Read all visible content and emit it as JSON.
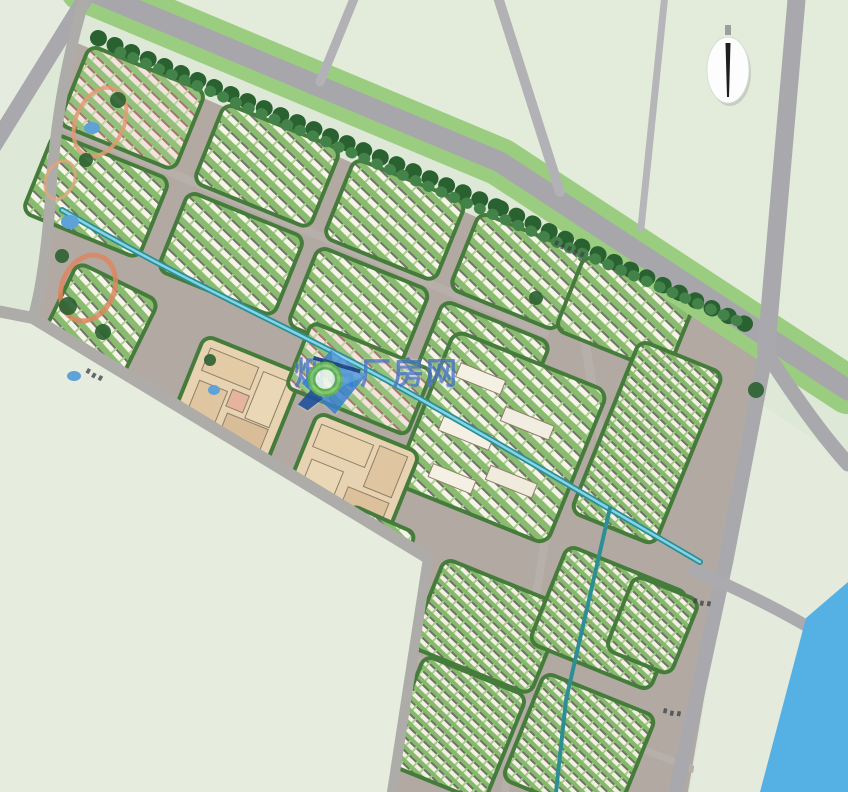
{
  "watermark": {
    "text": "烟台厂房网",
    "logo_name": "magnifier-diamond-logo",
    "color": "#2058c6"
  },
  "palette": {
    "background": "#dee8d7",
    "field_sw": "#e7edde",
    "field_ne": "#e3ecda",
    "field_tl": "#e5ecdf",
    "field_e": "#e4ebdc",
    "estate_street": "#b2aaa2",
    "road_major": "#a7a7ab",
    "road_minor": "#b2b1b5",
    "verge_green": "#9bcd80",
    "tree_dark": "#2a6130",
    "tree_light": "#43834a",
    "canal": "#2d8f94",
    "canal_highlight": "#84d4ea",
    "river": "#55b1e4",
    "campus_beige": "#e7d3b2",
    "block_edge_green": "#467c3b"
  },
  "map": {
    "estate_base": "75,42 770,345 750,400 728,558 688,792 392,792 428,556 33,318 48,205 58,86",
    "streets": [
      {
        "name": "street-upper-mid",
        "d": "M 58,124 L 545,333",
        "w": 8,
        "c": "#b7b0aa"
      },
      {
        "name": "street-vertical-east",
        "d": "M 560,192 L 612,505",
        "w": 9,
        "c": "#b7b0aa"
      },
      {
        "name": "street-canal-corridor",
        "d": "M 62,210 C 220,300 380,380 700,562",
        "w": 13,
        "c": "#b2aaa2"
      },
      {
        "name": "street-tail-mid",
        "d": "M 545,540 L 505,792",
        "w": 8,
        "c": "#b7b0aa"
      },
      {
        "name": "street-tail-cross",
        "d": "M 408,655 L 695,770",
        "w": 7,
        "c": "#b7b0aa"
      }
    ],
    "blocks": [
      {
        "name": "block-row-a1",
        "x": 90,
        "y": 45,
        "rot": 22,
        "w": 125,
        "h": 85,
        "rx": 10,
        "fill": "rowsPink"
      },
      {
        "name": "block-row-a2",
        "x": 225,
        "y": 103,
        "rot": 22,
        "w": 125,
        "h": 85,
        "rx": 10,
        "fill": "rows"
      },
      {
        "name": "block-row-a3",
        "x": 355,
        "y": 158,
        "rot": 22,
        "w": 120,
        "h": 85,
        "rx": 10,
        "fill": "rows"
      },
      {
        "name": "block-row-a4",
        "x": 480,
        "y": 212,
        "rot": 22,
        "w": 115,
        "h": 82,
        "rx": 10,
        "fill": "rows"
      },
      {
        "name": "block-row-b1",
        "x": 54,
        "y": 133,
        "rot": 22,
        "w": 125,
        "h": 85,
        "rx": 10,
        "fill": "rows"
      },
      {
        "name": "block-row-b2",
        "x": 189,
        "y": 191,
        "rot": 22,
        "w": 125,
        "h": 85,
        "rx": 10,
        "fill": "rows"
      },
      {
        "name": "block-row-b3",
        "x": 319,
        "y": 246,
        "rot": 22,
        "w": 120,
        "h": 85,
        "rx": 10,
        "fill": "rows"
      },
      {
        "name": "block-row-b4",
        "x": 444,
        "y": 300,
        "rot": 22,
        "w": 115,
        "h": 80,
        "rx": 10,
        "fill": "rows"
      },
      {
        "name": "block-upper-right",
        "x": 585,
        "y": 255,
        "rot": 22,
        "w": 120,
        "h": 80,
        "rx": 10,
        "fill": "rows"
      },
      {
        "name": "block-mid-large",
        "x": 455,
        "y": 330,
        "rot": 22,
        "w": 165,
        "h": 165,
        "rx": 12,
        "fill": "rows",
        "inner": [
          {
            "x": 18,
            "y": 28,
            "w": 48,
            "h": 15,
            "f": "#f4f1e4"
          },
          {
            "x": 76,
            "y": 52,
            "w": 52,
            "h": 15,
            "f": "#f1ede0"
          },
          {
            "x": 22,
            "y": 84,
            "w": 54,
            "h": 15,
            "f": "#f4f1e4"
          },
          {
            "x": 84,
            "y": 112,
            "w": 50,
            "h": 15,
            "f": "#efebdd"
          },
          {
            "x": 30,
            "y": 132,
            "w": 46,
            "h": 14,
            "f": "#f4f1e4"
          }
        ]
      },
      {
        "name": "block-mid-east",
        "x": 640,
        "y": 340,
        "rot": 22,
        "w": 90,
        "h": 185,
        "rx": 10,
        "fill": "rowsDense"
      },
      {
        "name": "block-lower-west",
        "x": 78,
        "y": 262,
        "rot": 26,
        "w": 90,
        "h": 120,
        "rx": 10,
        "fill": "rows"
      },
      {
        "name": "block-campus-west",
        "x": 205,
        "y": 335,
        "rot": 22,
        "w": 105,
        "h": 100,
        "rx": 10,
        "fill": "campus",
        "inner": [
          {
            "x": 10,
            "y": 10,
            "w": 52,
            "h": 24,
            "f": "#e3cba6"
          },
          {
            "x": 68,
            "y": 12,
            "w": 26,
            "h": 50,
            "f": "#ead7b6"
          },
          {
            "x": 12,
            "y": 44,
            "w": 30,
            "h": 38,
            "f": "#e0c6a0"
          },
          {
            "x": 50,
            "y": 64,
            "w": 44,
            "h": 26,
            "f": "#d8bd98"
          },
          {
            "x": 46,
            "y": 40,
            "w": 18,
            "h": 18,
            "f": "#e6b49e"
          }
        ]
      },
      {
        "name": "block-campus-east",
        "x": 318,
        "y": 412,
        "rot": 22,
        "w": 110,
        "h": 95,
        "rx": 10,
        "fill": "campus",
        "inner": [
          {
            "x": 8,
            "y": 10,
            "w": 56,
            "h": 24,
            "f": "#e8d2ae"
          },
          {
            "x": 70,
            "y": 8,
            "w": 30,
            "h": 44,
            "f": "#e0c6a0"
          },
          {
            "x": 12,
            "y": 46,
            "w": 34,
            "h": 36,
            "f": "#ead7b6"
          },
          {
            "x": 56,
            "y": 58,
            "w": 44,
            "h": 26,
            "f": "#dcc19c"
          }
        ]
      },
      {
        "name": "block-watermark-rows",
        "x": 312,
        "y": 322,
        "rot": 22,
        "w": 130,
        "h": 70,
        "rx": 8,
        "fill": "rowsPink"
      },
      {
        "name": "block-gap-south",
        "x": 352,
        "y": 505,
        "rot": 24,
        "w": 70,
        "h": 40,
        "rx": 8,
        "fill": "rows"
      },
      {
        "name": "block-tail-1",
        "x": 445,
        "y": 558,
        "rot": 22,
        "w": 130,
        "h": 95,
        "rx": 10,
        "fill": "rowsDense"
      },
      {
        "name": "block-tail-2",
        "x": 568,
        "y": 545,
        "rot": 22,
        "w": 130,
        "h": 105,
        "rx": 10,
        "fill": "rowsDense"
      },
      {
        "name": "block-tail-3",
        "x": 425,
        "y": 655,
        "rot": 22,
        "w": 110,
        "h": 115,
        "rx": 10,
        "fill": "rowsDense"
      },
      {
        "name": "block-tail-4",
        "x": 545,
        "y": 672,
        "rot": 22,
        "w": 120,
        "h": 115,
        "rx": 10,
        "fill": "rowsDense"
      },
      {
        "name": "block-tail-se",
        "x": 635,
        "y": 575,
        "rot": 22,
        "w": 70,
        "h": 80,
        "rx": 10,
        "fill": "rowsDense"
      }
    ],
    "canal": {
      "name": "canal",
      "d": "M 62,210 C 200,290 300,332 390,382 S 560,480 700,562"
    },
    "canal_branch": {
      "name": "canal-branch",
      "d": "M 610,508 L 566,700 L 556,792"
    },
    "fields": [
      {
        "name": "field-southwest",
        "pts": "0,312 30,316 425,556 390,792 0,792",
        "c": "#e7edde"
      },
      {
        "name": "field-northeast",
        "pts": "86,-12 500,160 848,388 848,-12",
        "c": "#e3ecda"
      },
      {
        "name": "field-topleft",
        "pts": "-5,-5 88,-5 -5,152",
        "c": "#e5ecdf"
      },
      {
        "name": "field-east",
        "pts": "752,398 728,560 690,792 775,792 848,658 848,462",
        "c": "#e4ebdc"
      }
    ],
    "roads": [
      {
        "name": "verge-main-artery",
        "d": "M 84,-12 L 500,162 L 848,390",
        "w": 48,
        "c": "#9bcd80"
      },
      {
        "name": "road-main-artery",
        "d": "M 84,-12 L 500,162 L 848,390",
        "w": 21,
        "c": "#a7a7ab"
      },
      {
        "name": "road-top-left",
        "d": "M 88,-6 L -10,152",
        "w": 16,
        "c": "#a9a9ad"
      },
      {
        "name": "road-top-a",
        "d": "M 356,-6 L 320,82",
        "w": 9,
        "c": "#b2b1b5"
      },
      {
        "name": "road-top-b",
        "d": "M 497,-6 L 560,192",
        "w": 10,
        "c": "#b2b1b5"
      },
      {
        "name": "road-top-c",
        "d": "M 665,-6 L 641,228",
        "w": 7,
        "c": "#b6b5b9"
      },
      {
        "name": "road-northeast",
        "d": "M 797,-6 L 766,352",
        "w": 18,
        "c": "#a9a9ad"
      },
      {
        "name": "road-east-continue",
        "d": "M 766,352 Q 812,424 848,464",
        "w": 15,
        "c": "#a9a9ad"
      },
      {
        "name": "road-southeast",
        "d": "M 766,352 L 726,560 L 676,792",
        "w": 15,
        "c": "#a9a9ad"
      },
      {
        "name": "road-river-bank",
        "d": "M 694,570 Q 790,612 848,652",
        "w": 12,
        "c": "#abaaae"
      },
      {
        "name": "road-southwest-boundary",
        "d": "M -8,310 L 33,318 L 428,558",
        "w": 12,
        "c": "#aeaca9"
      },
      {
        "name": "road-tail-west",
        "d": "M 428,558 L 392,792",
        "w": 10,
        "c": "#aeaca9"
      },
      {
        "name": "road-west-edge",
        "d": "M 86,-6 Q 56,90 50,205 Q 44,280 33,318",
        "w": 11,
        "c": "#aeaca9"
      }
    ],
    "tree_rows": [
      {
        "name": "tree-row-artery-west",
        "d": "M 98,38 L 500,208",
        "w": 16,
        "c": "#2a6130",
        "dash": "1 17"
      },
      {
        "name": "tree-row-artery-east",
        "d": "M 500,208 L 758,330",
        "w": 16,
        "c": "#2a6130",
        "dash": "1 17"
      },
      {
        "name": "tree-row-highlight",
        "d": "M 120,52 L 740,322",
        "w": 11,
        "c": "#43834a",
        "dash": "1 13"
      }
    ],
    "river": {
      "name": "river",
      "pts": "760,792 848,792 848,582 806,618",
      "c": "#55b1e4"
    },
    "ponds": [
      {
        "cx": 92,
        "cy": 128,
        "rx": 8,
        "ry": 6
      },
      {
        "cx": 70,
        "cy": 222,
        "rx": 9,
        "ry": 7
      },
      {
        "cx": 74,
        "cy": 376,
        "rx": 7,
        "ry": 5
      },
      {
        "cx": 214,
        "cy": 390,
        "rx": 6,
        "ry": 5
      }
    ],
    "park_arcs": [
      {
        "cx": 88,
        "cy": 288,
        "rx": 26,
        "ry": 34,
        "rot": 24,
        "c": "#dd8660",
        "w": 5
      },
      {
        "cx": 100,
        "cy": 122,
        "rx": 24,
        "ry": 36,
        "rot": 24,
        "c": "#e09a72",
        "w": 4
      },
      {
        "cx": 60,
        "cy": 180,
        "rx": 14,
        "ry": 20,
        "rot": 24,
        "c": "#e0a47a",
        "w": 3
      }
    ],
    "tree_blobs": [
      {
        "cx": 68,
        "cy": 306,
        "r": 9
      },
      {
        "cx": 103,
        "cy": 332,
        "r": 8
      },
      {
        "cx": 62,
        "cy": 256,
        "r": 7
      },
      {
        "cx": 118,
        "cy": 100,
        "r": 8
      },
      {
        "cx": 86,
        "cy": 160,
        "r": 7
      },
      {
        "cx": 210,
        "cy": 360,
        "r": 6
      },
      {
        "cx": 536,
        "cy": 298,
        "r": 7
      },
      {
        "cx": 756,
        "cy": 390,
        "r": 8
      }
    ],
    "road_marks": [
      {
        "x": 556,
        "y": 240,
        "rot": 24,
        "n": 5
      },
      {
        "x": 694,
        "y": 598,
        "rot": 12,
        "n": 3
      },
      {
        "x": 664,
        "y": 708,
        "rot": 12,
        "n": 3
      },
      {
        "x": 88,
        "y": 368,
        "rot": 30,
        "n": 3
      }
    ],
    "compass": {
      "cx": 728,
      "cy": 70,
      "rx": 21,
      "ry": 33
    }
  }
}
